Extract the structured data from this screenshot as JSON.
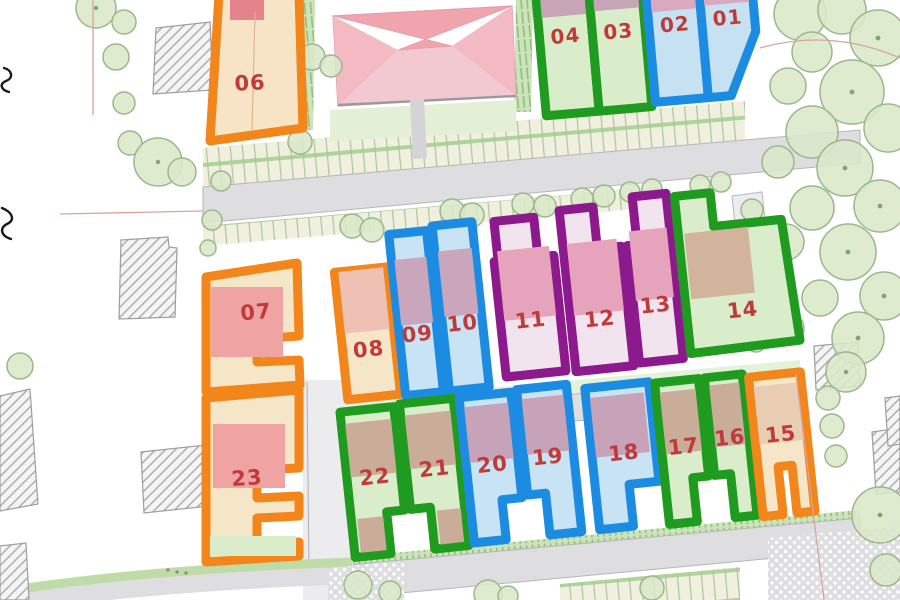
{
  "map": {
    "label_color": "#C13A3A",
    "plot_type_colors": {
      "blue": "#1C8CE2",
      "green": "#1F9C1F",
      "orange": "#F2861B",
      "purple": "#8C1A8C"
    },
    "plots": [
      {
        "number": "01",
        "type": "blue",
        "color": "#1C8CE2"
      },
      {
        "number": "02",
        "type": "blue",
        "color": "#1C8CE2"
      },
      {
        "number": "03",
        "type": "green",
        "color": "#1F9C1F"
      },
      {
        "number": "04",
        "type": "green",
        "color": "#1F9C1F"
      },
      {
        "number": "06",
        "type": "orange",
        "color": "#F2861B"
      },
      {
        "number": "07",
        "type": "orange",
        "color": "#F2861B"
      },
      {
        "number": "08",
        "type": "orange",
        "color": "#F2861B"
      },
      {
        "number": "09",
        "type": "blue",
        "color": "#1C8CE2"
      },
      {
        "number": "10",
        "type": "blue",
        "color": "#1C8CE2"
      },
      {
        "number": "11",
        "type": "purple",
        "color": "#8C1A8C"
      },
      {
        "number": "12",
        "type": "purple",
        "color": "#8C1A8C"
      },
      {
        "number": "13",
        "type": "purple",
        "color": "#8C1A8C"
      },
      {
        "number": "14",
        "type": "green",
        "color": "#1F9C1F"
      },
      {
        "number": "15",
        "type": "orange",
        "color": "#F2861B"
      },
      {
        "number": "16",
        "type": "green",
        "color": "#1F9C1F"
      },
      {
        "number": "17",
        "type": "green",
        "color": "#1F9C1F"
      },
      {
        "number": "18",
        "type": "blue",
        "color": "#1C8CE2"
      },
      {
        "number": "19",
        "type": "blue",
        "color": "#1C8CE2"
      },
      {
        "number": "20",
        "type": "blue",
        "color": "#1C8CE2"
      },
      {
        "number": "21",
        "type": "green",
        "color": "#1F9C1F"
      },
      {
        "number": "22",
        "type": "green",
        "color": "#1F9C1F"
      },
      {
        "number": "23",
        "type": "orange",
        "color": "#F2861B"
      }
    ]
  }
}
